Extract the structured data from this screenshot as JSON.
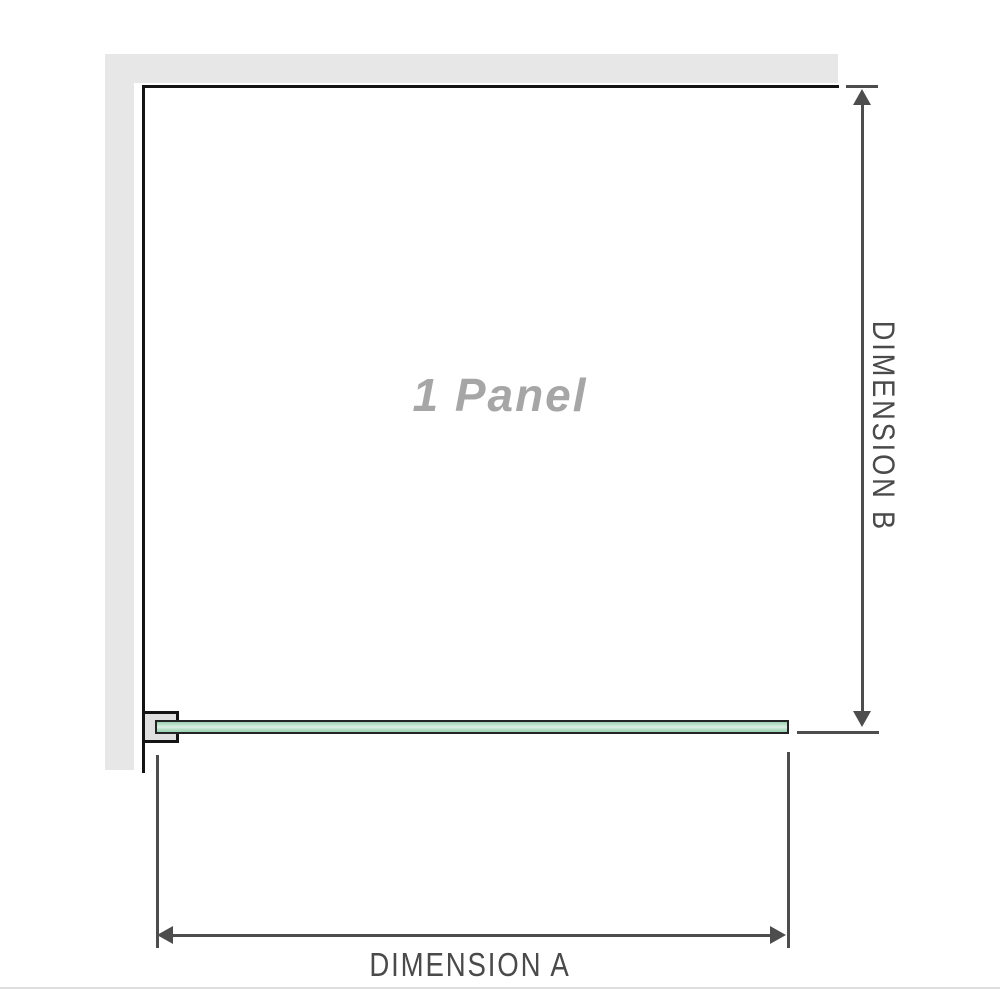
{
  "diagram": {
    "panel_label": "1 Panel",
    "dimension_a_label": "DIMENSION A",
    "dimension_b_label": "DIMENSION B"
  },
  "colors": {
    "wall": "#e7e7e7",
    "panel_edge": "#141414",
    "bracket_fill": "#e0e0e0",
    "glass_border": "#242424",
    "glass_green": "#9ad1b2",
    "glass_green_light": "#ddf0e6",
    "dimension": "#4d4d4d",
    "label_text": "#4a4a4a",
    "panel_label_text": "#a6a6a6",
    "divider": "#dedede"
  }
}
